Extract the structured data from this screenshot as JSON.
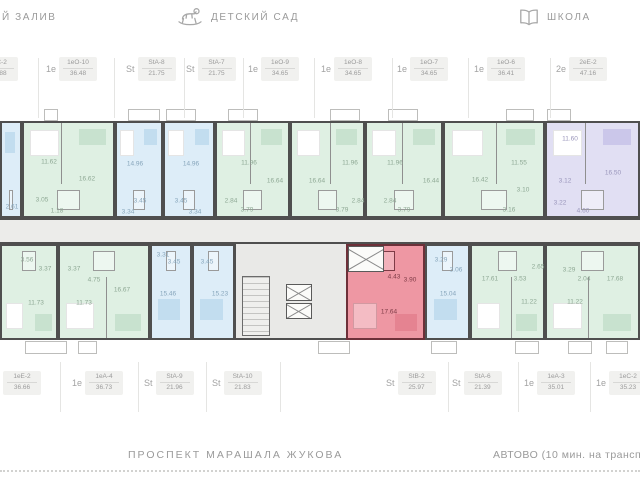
{
  "landmarks": {
    "left": {
      "label": "Й ЗАЛИВ"
    },
    "kindergarten": {
      "icon": "rocking-horse-icon",
      "label": "ДЕТСКИЙ САД"
    },
    "school": {
      "icon": "book-icon",
      "label": "ШКОЛА"
    }
  },
  "streets": {
    "main": "ПРОСПЕКТ МАРАШАЛА ЖУКОВА",
    "metro": "АВТОВО (10 мин. на трансп"
  },
  "colors": {
    "wall": "#4f4f4f",
    "green": "#dff0e3",
    "blue": "#ddedf8",
    "lavender": "#e1dff3",
    "highlight": "#ee97a3",
    "highlight_wall": "#6d3039",
    "corridor": "#ececea",
    "label_text": "#9b9b9b"
  },
  "units_top": [
    {
      "t": "St",
      "code": "StC-2",
      "area": "25.88",
      "x": -32
    },
    {
      "t": "1е",
      "code": "1еО-10",
      "area": "36.48",
      "x": 46
    },
    {
      "t": "St",
      "code": "StA-8",
      "area": "21.75",
      "x": 126
    },
    {
      "t": "St",
      "code": "StA-7",
      "area": "21.75",
      "x": 186
    },
    {
      "t": "1е",
      "code": "1еО-9",
      "area": "34.65",
      "x": 248
    },
    {
      "t": "1е",
      "code": "1еО-8",
      "area": "34.65",
      "x": 321
    },
    {
      "t": "1е",
      "code": "1еО-7",
      "area": "34.65",
      "x": 397
    },
    {
      "t": "1е",
      "code": "1еО-6",
      "area": "36.41",
      "x": 474
    },
    {
      "t": "2е",
      "code": "2еЕ-2",
      "area": "47.16",
      "x": 556
    }
  ],
  "units_bottom": [
    {
      "t": "1е",
      "code": "1еЕ-2",
      "area": "36.66",
      "x": -10
    },
    {
      "t": "1е",
      "code": "1еА-4",
      "area": "36.73",
      "x": 72
    },
    {
      "t": "St",
      "code": "StA-9",
      "area": "21.96",
      "x": 144
    },
    {
      "t": "St",
      "code": "StA-10",
      "area": "21.83",
      "x": 212
    },
    {
      "t": "St",
      "code": "StB-2",
      "area": "25.97",
      "x": 386,
      "highlight": true
    },
    {
      "t": "St",
      "code": "StA-6",
      "area": "21.39",
      "x": 452
    },
    {
      "t": "1е",
      "code": "1еА-3",
      "area": "35.01",
      "x": 524
    },
    {
      "t": "1е",
      "code": "1еС-2",
      "area": "35.23",
      "x": 596
    }
  ],
  "plan": {
    "apartments": [
      {
        "code": "edge-top",
        "type": "blue",
        "x": 0,
        "y": 121,
        "w": 22,
        "h": 97,
        "rooms": [
          {
            "v": "2.61",
            "x": 10,
            "y": 84
          }
        ]
      },
      {
        "code": "1еО-10",
        "type": "green",
        "x": 22,
        "y": 121,
        "w": 93,
        "h": 97,
        "d": 0.42,
        "rooms": [
          {
            "v": "11.62",
            "x": 25,
            "y": 39
          },
          {
            "v": "16.62",
            "x": 63,
            "y": 56
          },
          {
            "v": "3.05",
            "x": 18,
            "y": 77
          },
          {
            "v": "1.18",
            "x": 33,
            "y": 88
          }
        ]
      },
      {
        "code": "StA-8",
        "type": "blue",
        "x": 115,
        "y": 121,
        "w": 48,
        "h": 97,
        "rooms": [
          {
            "v": "14.96",
            "x": 18,
            "y": 41
          },
          {
            "v": "3.45",
            "x": 23,
            "y": 78
          },
          {
            "v": "3.34",
            "x": 11,
            "y": 89
          }
        ]
      },
      {
        "code": "StA-7",
        "type": "blue",
        "x": 163,
        "y": 121,
        "w": 52,
        "h": 97,
        "rooms": [
          {
            "v": "14.96",
            "x": 26,
            "y": 41
          },
          {
            "v": "3.45",
            "x": 16,
            "y": 78
          },
          {
            "v": "3.34",
            "x": 30,
            "y": 89
          }
        ]
      },
      {
        "code": "1еО-9",
        "type": "green",
        "x": 215,
        "y": 121,
        "w": 75,
        "h": 97,
        "d": 0.47,
        "rooms": [
          {
            "v": "11.96",
            "x": 32,
            "y": 40
          },
          {
            "v": "16.64",
            "x": 58,
            "y": 58
          },
          {
            "v": "2.84",
            "x": 14,
            "y": 78
          },
          {
            "v": "3.79",
            "x": 30,
            "y": 87
          }
        ]
      },
      {
        "code": "1еО-8",
        "type": "green",
        "x": 290,
        "y": 121,
        "w": 75,
        "h": 97,
        "d": 0.53,
        "rooms": [
          {
            "v": "16.64",
            "x": 25,
            "y": 58
          },
          {
            "v": "11.96",
            "x": 58,
            "y": 40
          },
          {
            "v": "2.84",
            "x": 66,
            "y": 78
          },
          {
            "v": "3.79",
            "x": 50,
            "y": 87
          }
        ]
      },
      {
        "code": "1еО-7",
        "type": "green",
        "x": 365,
        "y": 121,
        "w": 78,
        "h": 97,
        "d": 0.47,
        "rooms": [
          {
            "v": "11.96",
            "x": 28,
            "y": 40
          },
          {
            "v": "16.44",
            "x": 64,
            "y": 58
          },
          {
            "v": "2.84",
            "x": 23,
            "y": 78
          },
          {
            "v": "3.79",
            "x": 37,
            "y": 87
          }
        ]
      },
      {
        "code": "1еО-6",
        "type": "green",
        "x": 443,
        "y": 121,
        "w": 102,
        "h": 97,
        "d": 0.52,
        "rooms": [
          {
            "v": "16.42",
            "x": 35,
            "y": 57
          },
          {
            "v": "11.55",
            "x": 74,
            "y": 40
          },
          {
            "v": "3.10",
            "x": 78,
            "y": 67
          },
          {
            "v": "3.16",
            "x": 64,
            "y": 87
          }
        ]
      },
      {
        "code": "2еЕ-2",
        "type": "lav",
        "x": 545,
        "y": 121,
        "w": 95,
        "h": 97,
        "d": 0.42,
        "rooms": [
          {
            "v": "11.60",
            "x": 23,
            "y": 16
          },
          {
            "v": "16.50",
            "x": 66,
            "y": 50
          },
          {
            "v": "3.12",
            "x": 18,
            "y": 58
          },
          {
            "v": "3.22",
            "x": 13,
            "y": 80
          },
          {
            "v": "4.60",
            "x": 36,
            "y": 88
          }
        ]
      },
      {
        "code": "1еЕ-2",
        "type": "green",
        "x": 0,
        "y": 244,
        "w": 58,
        "h": 96,
        "rooms": [
          {
            "v": "3.56",
            "x": 25,
            "y": 14
          },
          {
            "v": "3.37",
            "x": 43,
            "y": 23
          },
          {
            "v": "11.73",
            "x": 34,
            "y": 57
          }
        ]
      },
      {
        "code": "1еА-4",
        "type": "green",
        "x": 58,
        "y": 244,
        "w": 92,
        "h": 96,
        "d": 0.52,
        "rooms": [
          {
            "v": "3.37",
            "x": 14,
            "y": 23
          },
          {
            "v": "4.75",
            "x": 34,
            "y": 34
          },
          {
            "v": "11.73",
            "x": 24,
            "y": 57
          },
          {
            "v": "16.67",
            "x": 62,
            "y": 44
          }
        ]
      },
      {
        "code": "StA-9",
        "type": "blue",
        "x": 150,
        "y": 244,
        "w": 42,
        "h": 96,
        "rooms": [
          {
            "v": "3.31",
            "x": 11,
            "y": 9
          },
          {
            "v": "3.45",
            "x": 22,
            "y": 16
          },
          {
            "v": "15.46",
            "x": 16,
            "y": 48
          }
        ]
      },
      {
        "code": "StA-10",
        "type": "blue",
        "x": 192,
        "y": 244,
        "w": 43,
        "h": 96,
        "rooms": [
          {
            "v": "3.45",
            "x": 13,
            "y": 16
          },
          {
            "v": "15.23",
            "x": 26,
            "y": 48
          }
        ]
      },
      {
        "code": "StB-2",
        "type": "red",
        "x": 346,
        "y": 244,
        "w": 79,
        "h": 96,
        "rooms": [
          {
            "v": "4.43",
            "x": 46,
            "y": 31
          },
          {
            "v": "3.90",
            "x": 62,
            "y": 34
          },
          {
            "v": "17.64",
            "x": 41,
            "y": 66
          }
        ]
      },
      {
        "code": "StA-6",
        "type": "blue",
        "x": 425,
        "y": 244,
        "w": 45,
        "h": 96,
        "rooms": [
          {
            "v": "3.29",
            "x": 14,
            "y": 14
          },
          {
            "v": "3.06",
            "x": 29,
            "y": 24
          },
          {
            "v": "15.04",
            "x": 21,
            "y": 48
          }
        ]
      },
      {
        "code": "1еА-3",
        "type": "green",
        "x": 470,
        "y": 244,
        "w": 75,
        "h": 96,
        "d": 0.55,
        "rooms": [
          {
            "v": "17.61",
            "x": 18,
            "y": 33
          },
          {
            "v": "3.53",
            "x": 48,
            "y": 33
          },
          {
            "v": "2.65",
            "x": 66,
            "y": 21
          },
          {
            "v": "11.22",
            "x": 57,
            "y": 56
          }
        ]
      },
      {
        "code": "1еС-2",
        "type": "green",
        "x": 545,
        "y": 244,
        "w": 95,
        "h": 96,
        "d": 0.45,
        "rooms": [
          {
            "v": "3.29",
            "x": 22,
            "y": 24
          },
          {
            "v": "2.04",
            "x": 37,
            "y": 33
          },
          {
            "v": "11.22",
            "x": 28,
            "y": 56
          },
          {
            "v": "17.68",
            "x": 68,
            "y": 33
          }
        ]
      }
    ],
    "balconies_top": [
      {
        "x": 44,
        "w": 14
      },
      {
        "x": 128,
        "w": 32
      },
      {
        "x": 166,
        "w": 30
      },
      {
        "x": 228,
        "w": 30
      },
      {
        "x": 330,
        "w": 30
      },
      {
        "x": 388,
        "w": 30
      },
      {
        "x": 506,
        "w": 28
      },
      {
        "x": 547,
        "w": 24
      }
    ],
    "balconies_bottom": [
      {
        "x": 25,
        "w": 42
      },
      {
        "x": 78,
        "w": 19
      },
      {
        "x": 318,
        "w": 32
      },
      {
        "x": 431,
        "w": 26
      },
      {
        "x": 515,
        "w": 24
      },
      {
        "x": 568,
        "w": 24
      },
      {
        "x": 606,
        "w": 22
      }
    ],
    "separators_top": [
      38,
      114,
      184,
      243,
      314,
      392,
      468,
      550
    ],
    "separators_bottom": [
      60,
      138,
      206,
      280,
      448,
      518,
      590
    ]
  }
}
